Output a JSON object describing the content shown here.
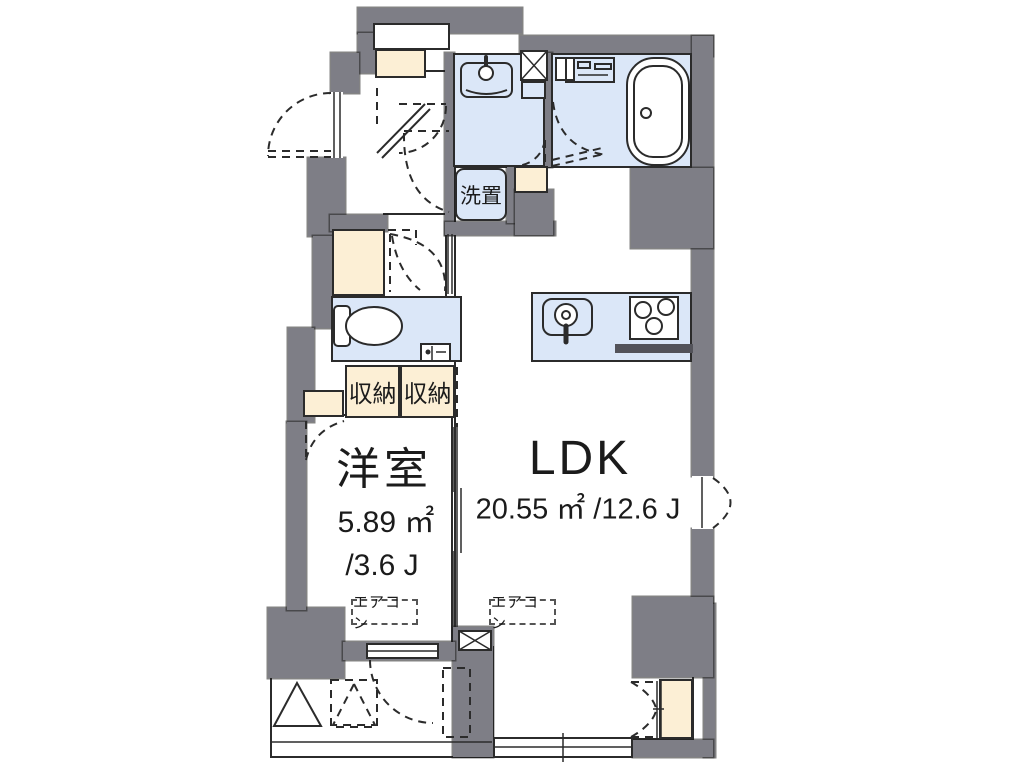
{
  "plan": {
    "rooms": {
      "western": {
        "name": "洋室",
        "area_m2": "5.89 ㎡",
        "area_jo": "/3.6 J"
      },
      "ldk": {
        "name": "LDK",
        "area": "20.55 ㎡ /12.6 J"
      }
    },
    "labels": {
      "laundry": "洗置",
      "storage1": "収納",
      "storage2": "収納",
      "aircon_western": "エアコン",
      "aircon_ldk": "エアコン"
    },
    "colors": {
      "wall": "#7e7e86",
      "wet_area": "#dbe7f8",
      "storage": "#fcefd5",
      "line": "#2b2b2b",
      "counter_bar": "#53535a"
    }
  }
}
